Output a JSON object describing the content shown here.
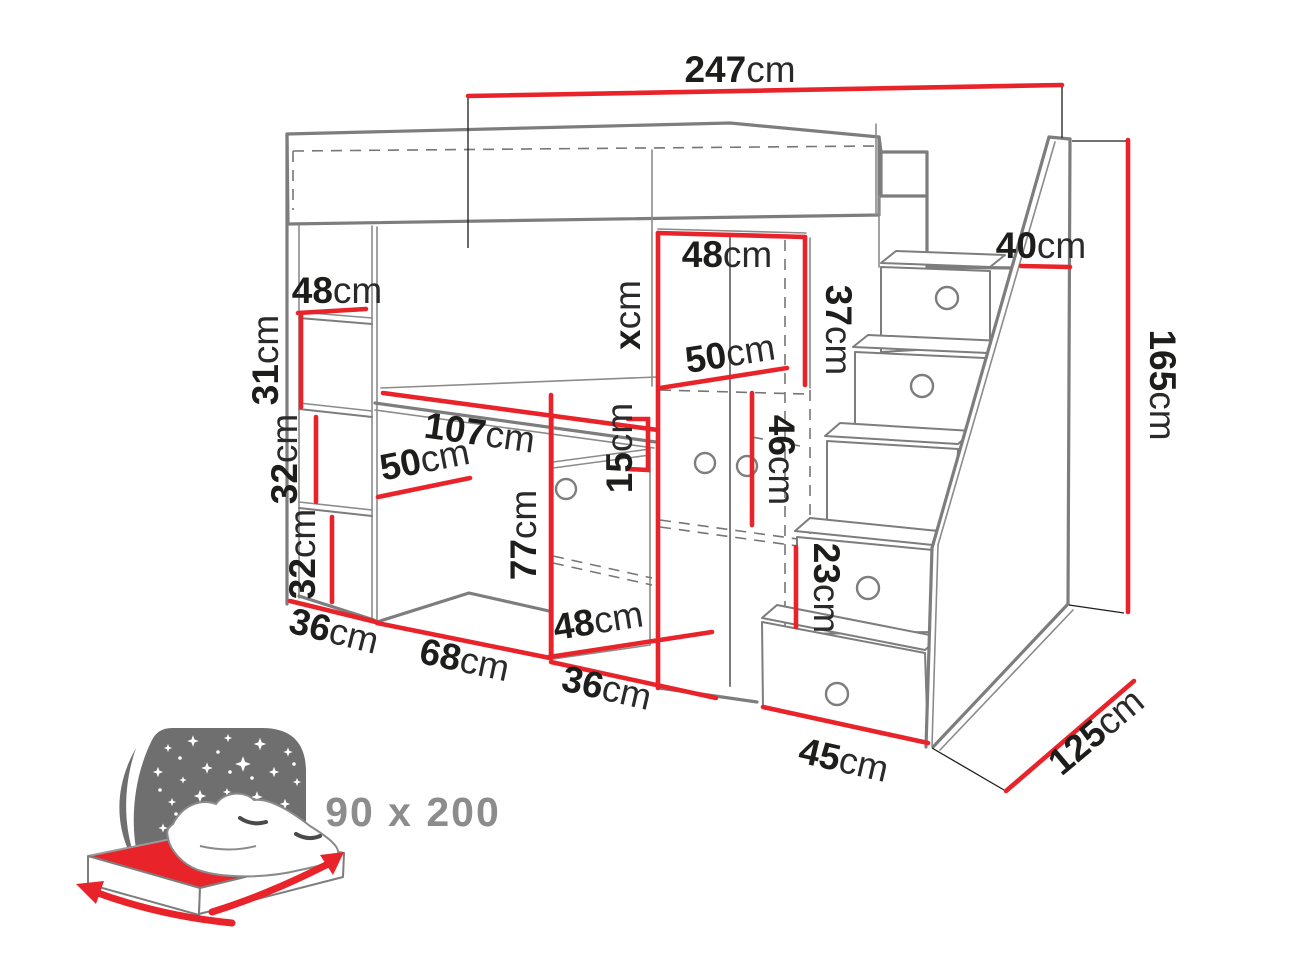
{
  "diagram": {
    "type": "furniture-dimension-drawing",
    "subject": "loft bed with desk, shelves, wardrobe and staircase drawers",
    "unit": "cm",
    "colors": {
      "dimension_line": "#e8242a",
      "outline": "#7d7d7d",
      "label_text": "#1d1d1b",
      "icon_gray": "#6f6f6f",
      "bed_size_text": "#8c8c8c"
    },
    "dimensions": {
      "total_width": {
        "num": "247",
        "unit": "cm"
      },
      "top_shelf_width": {
        "num": "48",
        "unit": "cm"
      },
      "shelf_gap_top": {
        "num": "31",
        "unit": "cm"
      },
      "shelf_gap_middle": {
        "num": "32",
        "unit": "cm"
      },
      "shelf_gap_bottom": {
        "num": "32",
        "unit": "cm"
      },
      "side_depth": {
        "num": "36",
        "unit": "cm"
      },
      "desk_width": {
        "num": "107",
        "unit": "cm"
      },
      "desk_depth": {
        "num": "50",
        "unit": "cm"
      },
      "cabinet_height": {
        "num": "77",
        "unit": "cm"
      },
      "desk_niche_width": {
        "num": "68",
        "unit": "cm"
      },
      "cabinet_width": {
        "num": "48",
        "unit": "cm"
      },
      "cabinet_depth": {
        "num": "36",
        "unit": "cm"
      },
      "wardrobe_height": {
        "num": "x",
        "unit": "cm"
      },
      "shelf_height": {
        "num": "15",
        "unit": "cm"
      },
      "wardrobe_width": {
        "num": "48",
        "unit": "cm"
      },
      "wardrobe_depth": {
        "num": "50",
        "unit": "cm"
      },
      "wardrobe_top_height": {
        "num": "37",
        "unit": "cm"
      },
      "wardrobe_inner_height": {
        "num": "46",
        "unit": "cm"
      },
      "stair_top_depth": {
        "num": "40",
        "unit": "cm"
      },
      "stair_rise": {
        "num": "23",
        "unit": "cm"
      },
      "total_height": {
        "num": "165",
        "unit": "cm"
      },
      "stair_width": {
        "num": "45",
        "unit": "cm"
      },
      "total_depth": {
        "num": "125",
        "unit": "cm"
      }
    },
    "mattress_size": {
      "label": "90 x 200"
    }
  }
}
